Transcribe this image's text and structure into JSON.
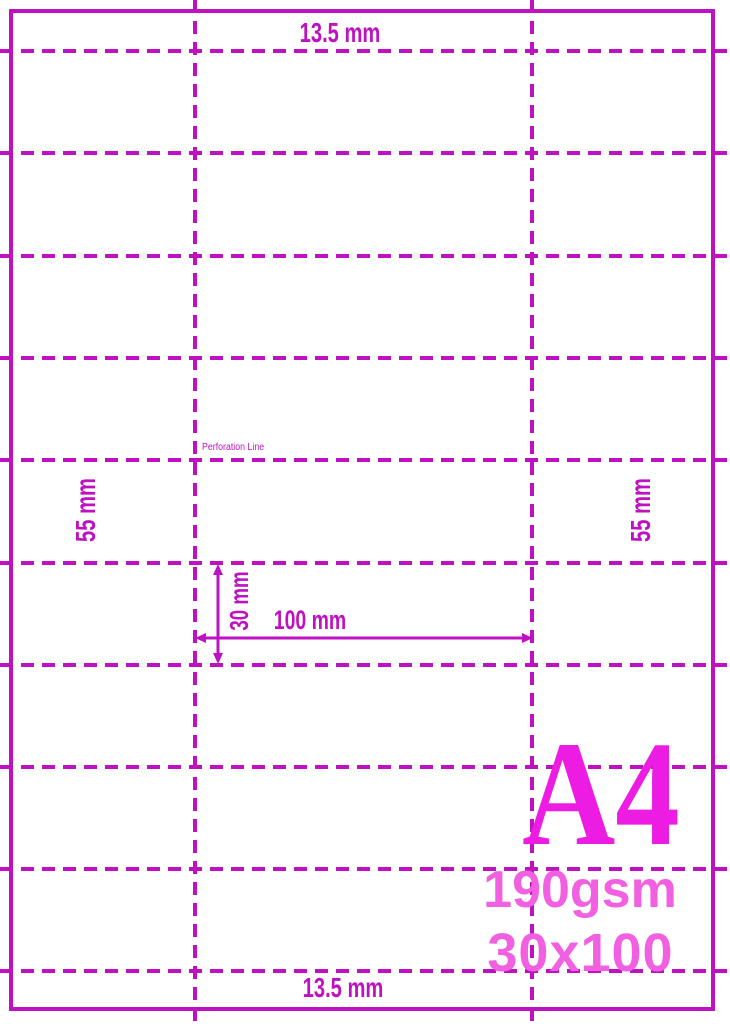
{
  "labels": {
    "top_margin": "13.5 mm",
    "bottom_margin": "13.5 mm",
    "left_strip": "55 mm",
    "right_strip": "55 mm",
    "row_height": "30 mm",
    "label_width": "100 mm",
    "perforation_line": "Perforation Line"
  },
  "badge": {
    "size": "A4",
    "weight": "190gsm",
    "dimensions": "30x100"
  },
  "colors": {
    "line": "#BE12C2",
    "a4": "#ED1CE3",
    "spec": "#F160E0"
  }
}
